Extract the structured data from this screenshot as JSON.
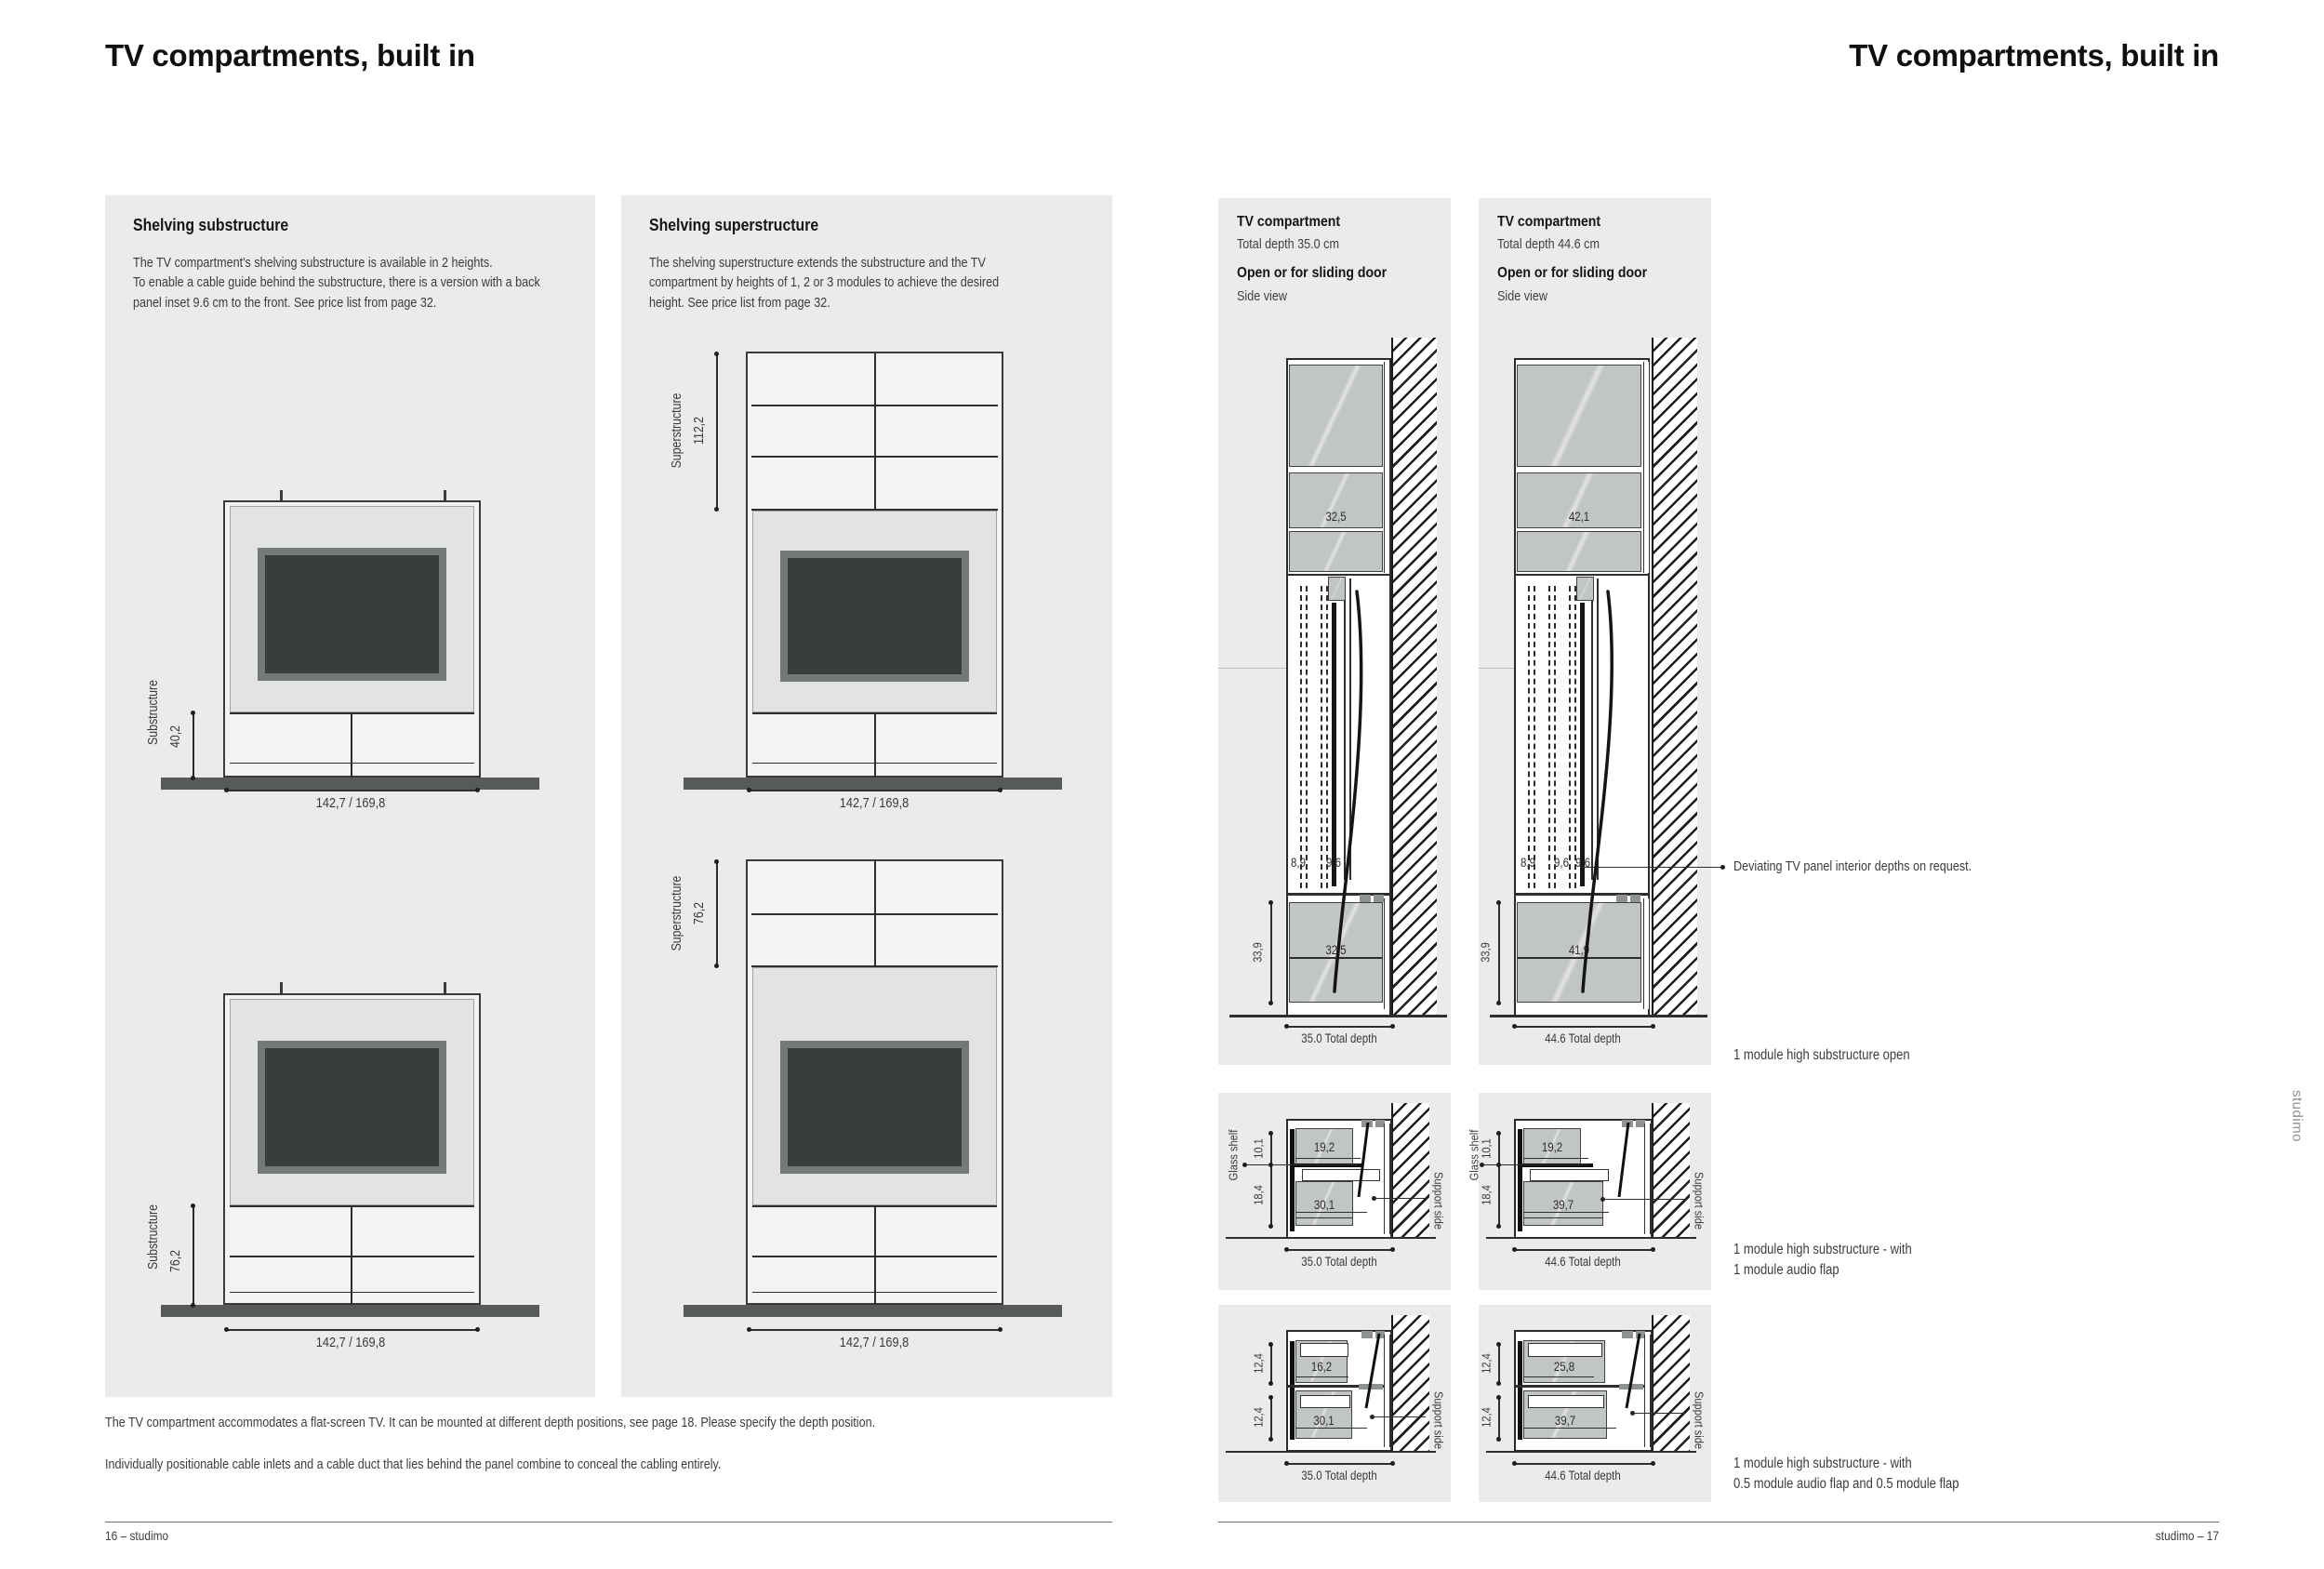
{
  "page": {
    "title_left": "TV compartments, built in",
    "title_right": "TV compartments, built in",
    "footer_left": "16 – studimo",
    "footer_right": "studimo – 17",
    "brand_vertical": "studimo",
    "colors": {
      "panel_bg": "#ebebeb",
      "drawing_gray": "#c1c5c3",
      "tv_screen": "#393d3c",
      "floor": "#565a59"
    }
  },
  "substructure_panel": {
    "heading": "Shelving substructure",
    "body": "The TV compartment's shelving substructure is available in 2 heights.\nTo enable a cable guide behind the substructure, there is a version with a back\npanel inset 9.6 cm to the front. See price list from page 32.",
    "drawing1": {
      "label": "Substructure",
      "value": "40,2",
      "width_dim": "142,7 / 169,8"
    },
    "drawing2": {
      "label": "Substructure",
      "value": "76,2",
      "width_dim": "142,7 / 169,8"
    }
  },
  "superstructure_panel": {
    "heading": "Shelving superstructure",
    "body": "The shelving superstructure extends the substructure and the TV\ncompartment by heights of 1, 2 or 3 modules to achieve the desired\nheight. See price list from page 32.",
    "drawing1": {
      "label": "Superstructure",
      "value": "112,2",
      "width_dim": "142,7 / 169,8"
    },
    "drawing2": {
      "label": "Superstructure",
      "value": "76,2",
      "width_dim": "142,7 / 169,8"
    }
  },
  "notes": {
    "line1": "The TV compartment accommodates a flat-screen TV.  It can be mounted at different depth positions, see page 18. Please specify the depth position.",
    "line2": "Individually positionable cable inlets and a cable duct that lies behind the panel combine to conceal the cabling entirely."
  },
  "side_views": [
    {
      "title": "TV compartment",
      "total_depth": "Total depth 35.0 cm",
      "mode": "Open or for sliding door",
      "view": "Side view",
      "upper_depth": "32,5",
      "tv_dims": {
        "d1": "8,9",
        "d2": "9,6"
      },
      "base_height": "33,9",
      "base_depth": "32,5",
      "total_dim": "35.0 Total depth"
    },
    {
      "title": "TV compartment",
      "total_depth": "Total depth 44.6 cm",
      "mode": "Open or for sliding door",
      "view": "Side view",
      "upper_depth": "42,1",
      "tv_dims": {
        "d1": "8,9",
        "d2": "9,6",
        "d3": "9,6"
      },
      "base_height": "33,9",
      "base_depth": "41,9",
      "total_dim": "44.6 Total depth"
    }
  ],
  "callout": "Deviating TV panel interior depths on request.",
  "captions": {
    "open": "1 module high substructure open",
    "audio_flap": "1 module high substructure - with\n1 module audio flap",
    "half_flaps": "1 module high substructure - with\n0.5 module audio flap and 0.5 module flap"
  },
  "audio_flap_views": [
    {
      "glass_shelf": "Glass shelf",
      "upper_height": "10,1",
      "lower_height": "18,4",
      "upper_depth": "19,2",
      "lower_depth": "30,1",
      "support": "Support side",
      "total_dim": "35.0 Total depth"
    },
    {
      "glass_shelf": "Glass shelf",
      "upper_height": "10,1",
      "lower_height": "18,4",
      "upper_depth": "19,2",
      "lower_depth": "39,7",
      "support": "Support side",
      "total_dim": "44.6 Total depth"
    }
  ],
  "flap_views": [
    {
      "upper_height": "12,4",
      "lower_height": "12,4",
      "upper_depth": "16,2",
      "lower_depth": "30,1",
      "support": "Support side",
      "total_dim": "35.0 Total depth"
    },
    {
      "upper_height": "12,4",
      "lower_height": "12,4",
      "upper_depth": "25,8",
      "lower_depth": "39,7",
      "support": "Support side",
      "total_dim": "44.6 Total depth"
    }
  ]
}
